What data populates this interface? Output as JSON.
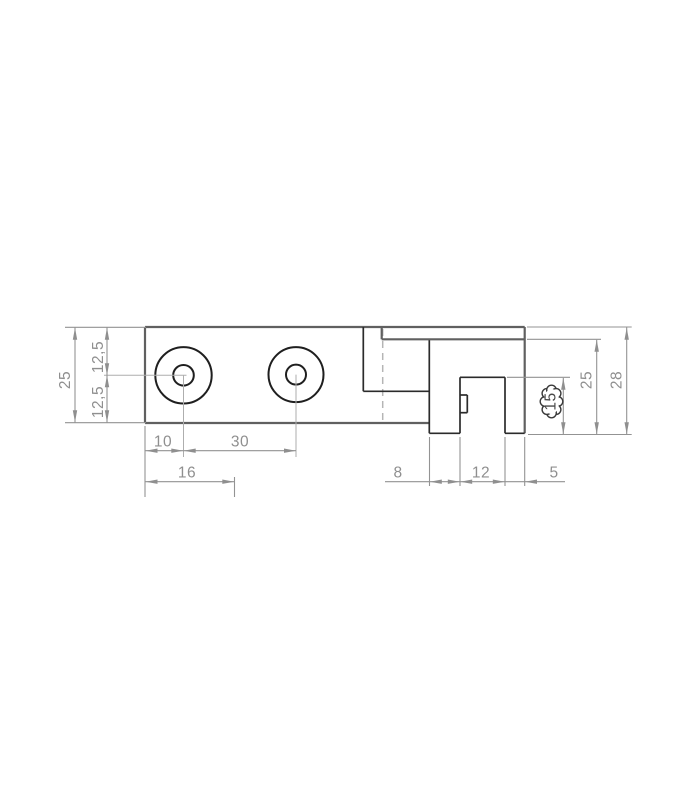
{
  "drawing": {
    "kind": "technical-dimension-drawing",
    "views": {
      "front": {
        "dims": {
          "height_total": "25",
          "hole_offset_upper": "12,5",
          "hole_offset_lower": "12,5",
          "edge_to_first_hole": "10",
          "hole_spacing": "30",
          "base_width": "16"
        }
      },
      "side": {
        "dims": {
          "flange_width": "8",
          "slot_width": "12",
          "lip_width": "5",
          "slot_depth": "15",
          "body_height": "25",
          "overall_height": "28"
        }
      }
    },
    "colors": {
      "background": "#ffffff",
      "edge_outer": "#606060",
      "edge_inner": "#2b2b2b",
      "dimension_gray": "#8f8f8f",
      "centerline_gray": "#aeaeae",
      "revision_cloud": "#3a3a3a"
    }
  }
}
